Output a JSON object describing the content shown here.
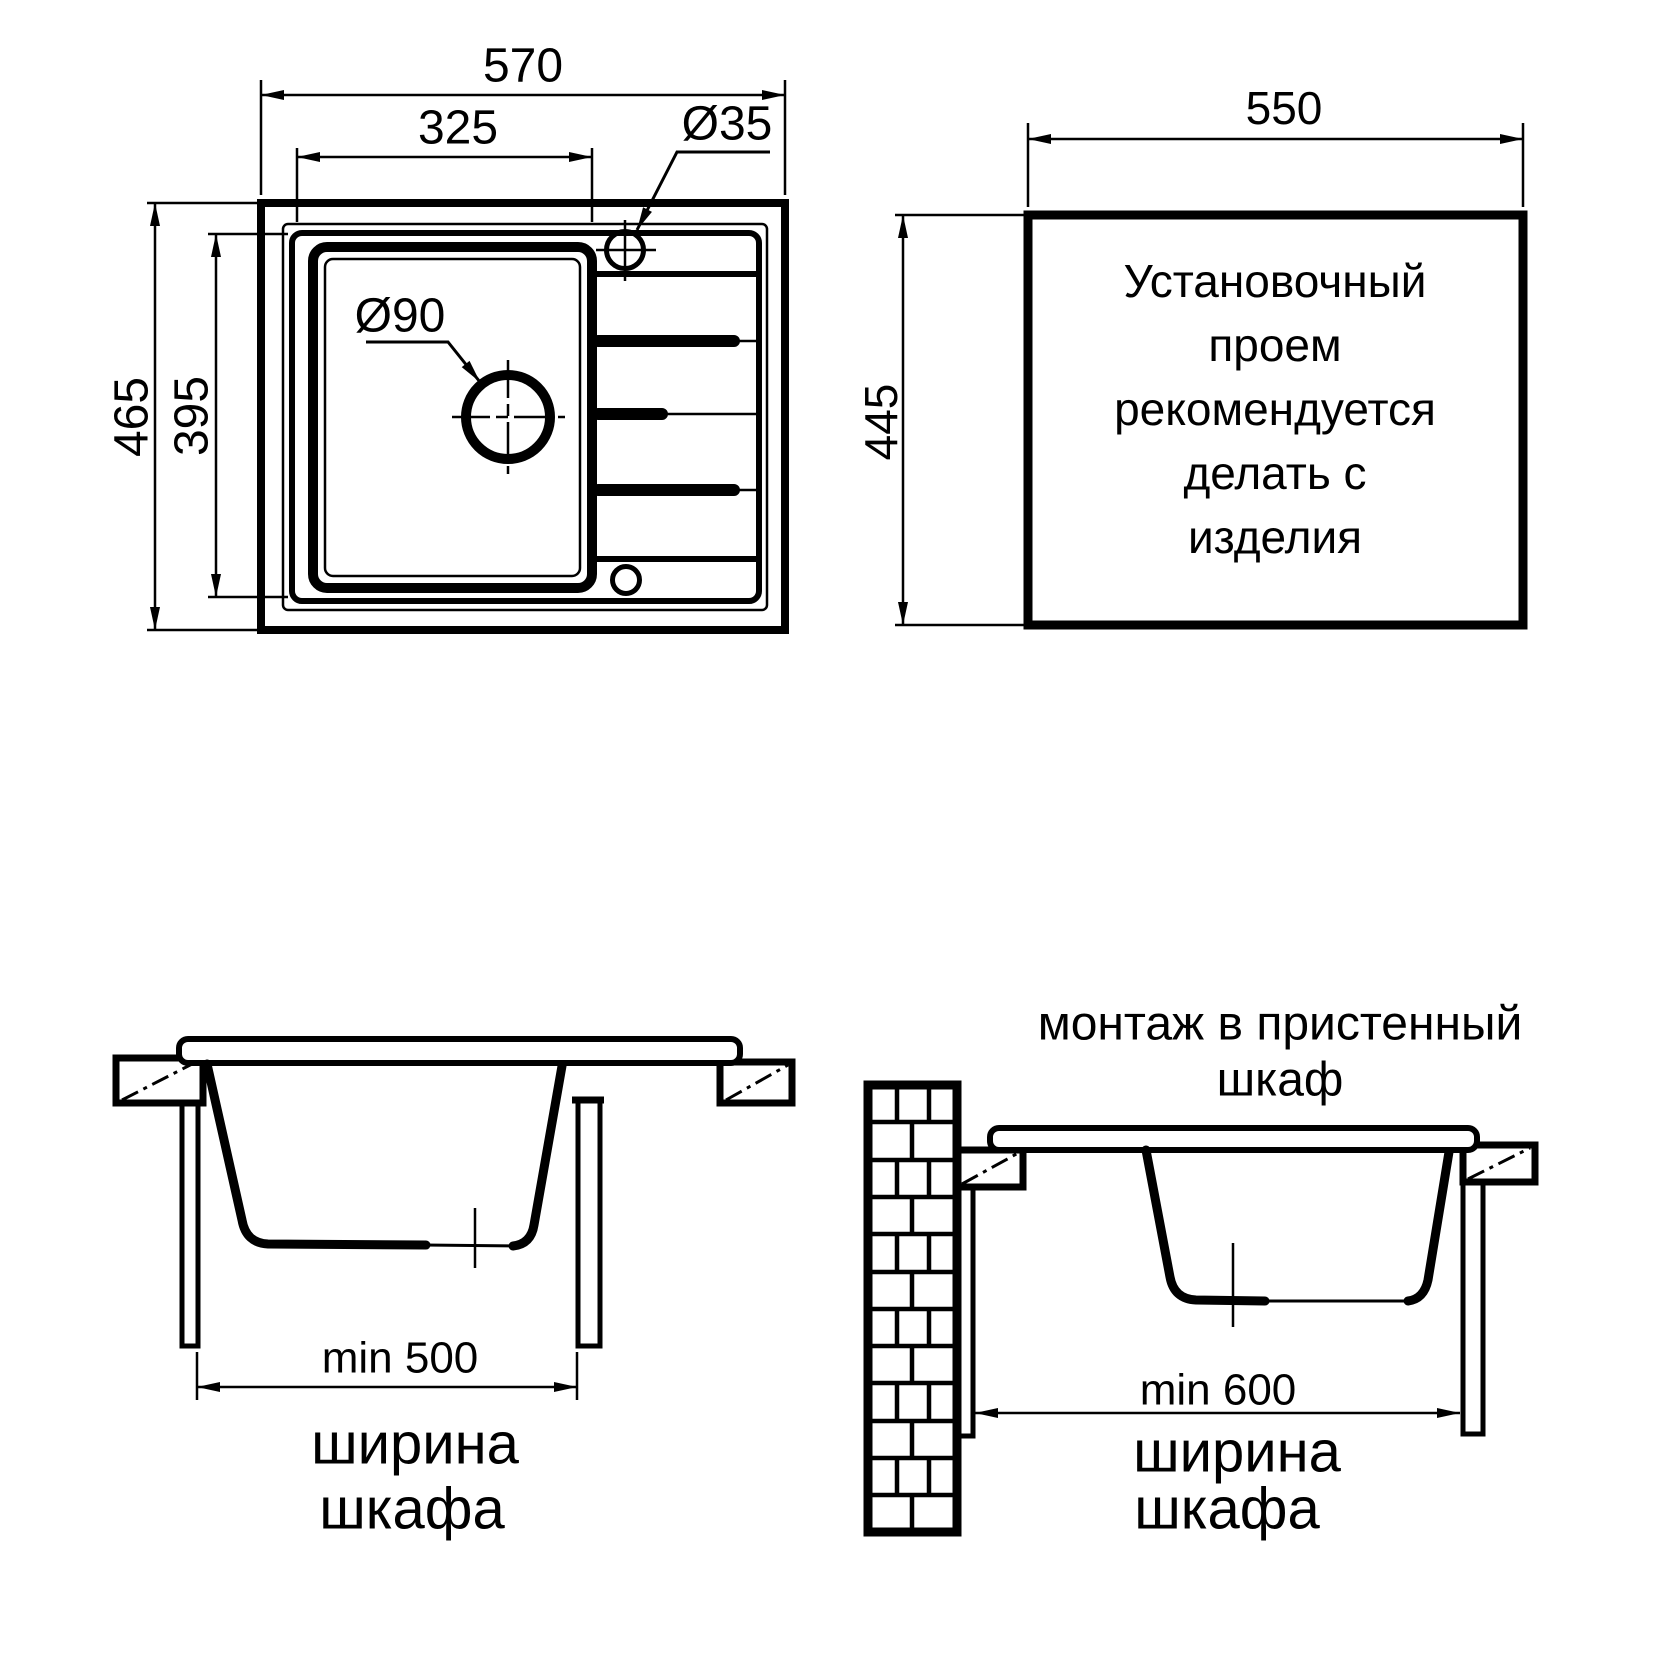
{
  "top_view": {
    "dim_width": "570",
    "dim_inner_width": "325",
    "dim_height": "465",
    "dim_inner_height": "395",
    "faucet_hole_label": "Ø35",
    "drain_hole_label": "Ø90"
  },
  "cutout": {
    "dim_width": "550",
    "dim_height": "445",
    "note": [
      "Установочный",
      "проем",
      "рекомендуется",
      "делать с",
      "изделия"
    ]
  },
  "section_base": {
    "dim_label": "min 500",
    "caption": [
      "ширина",
      "шкафа"
    ]
  },
  "section_wall": {
    "title": [
      "монтаж в пристенный",
      "шкаф"
    ],
    "dim_label": "min 600",
    "caption": [
      "ширина",
      "шкафа"
    ]
  },
  "colors": {
    "ink": "#000000",
    "background": "#ffffff"
  }
}
